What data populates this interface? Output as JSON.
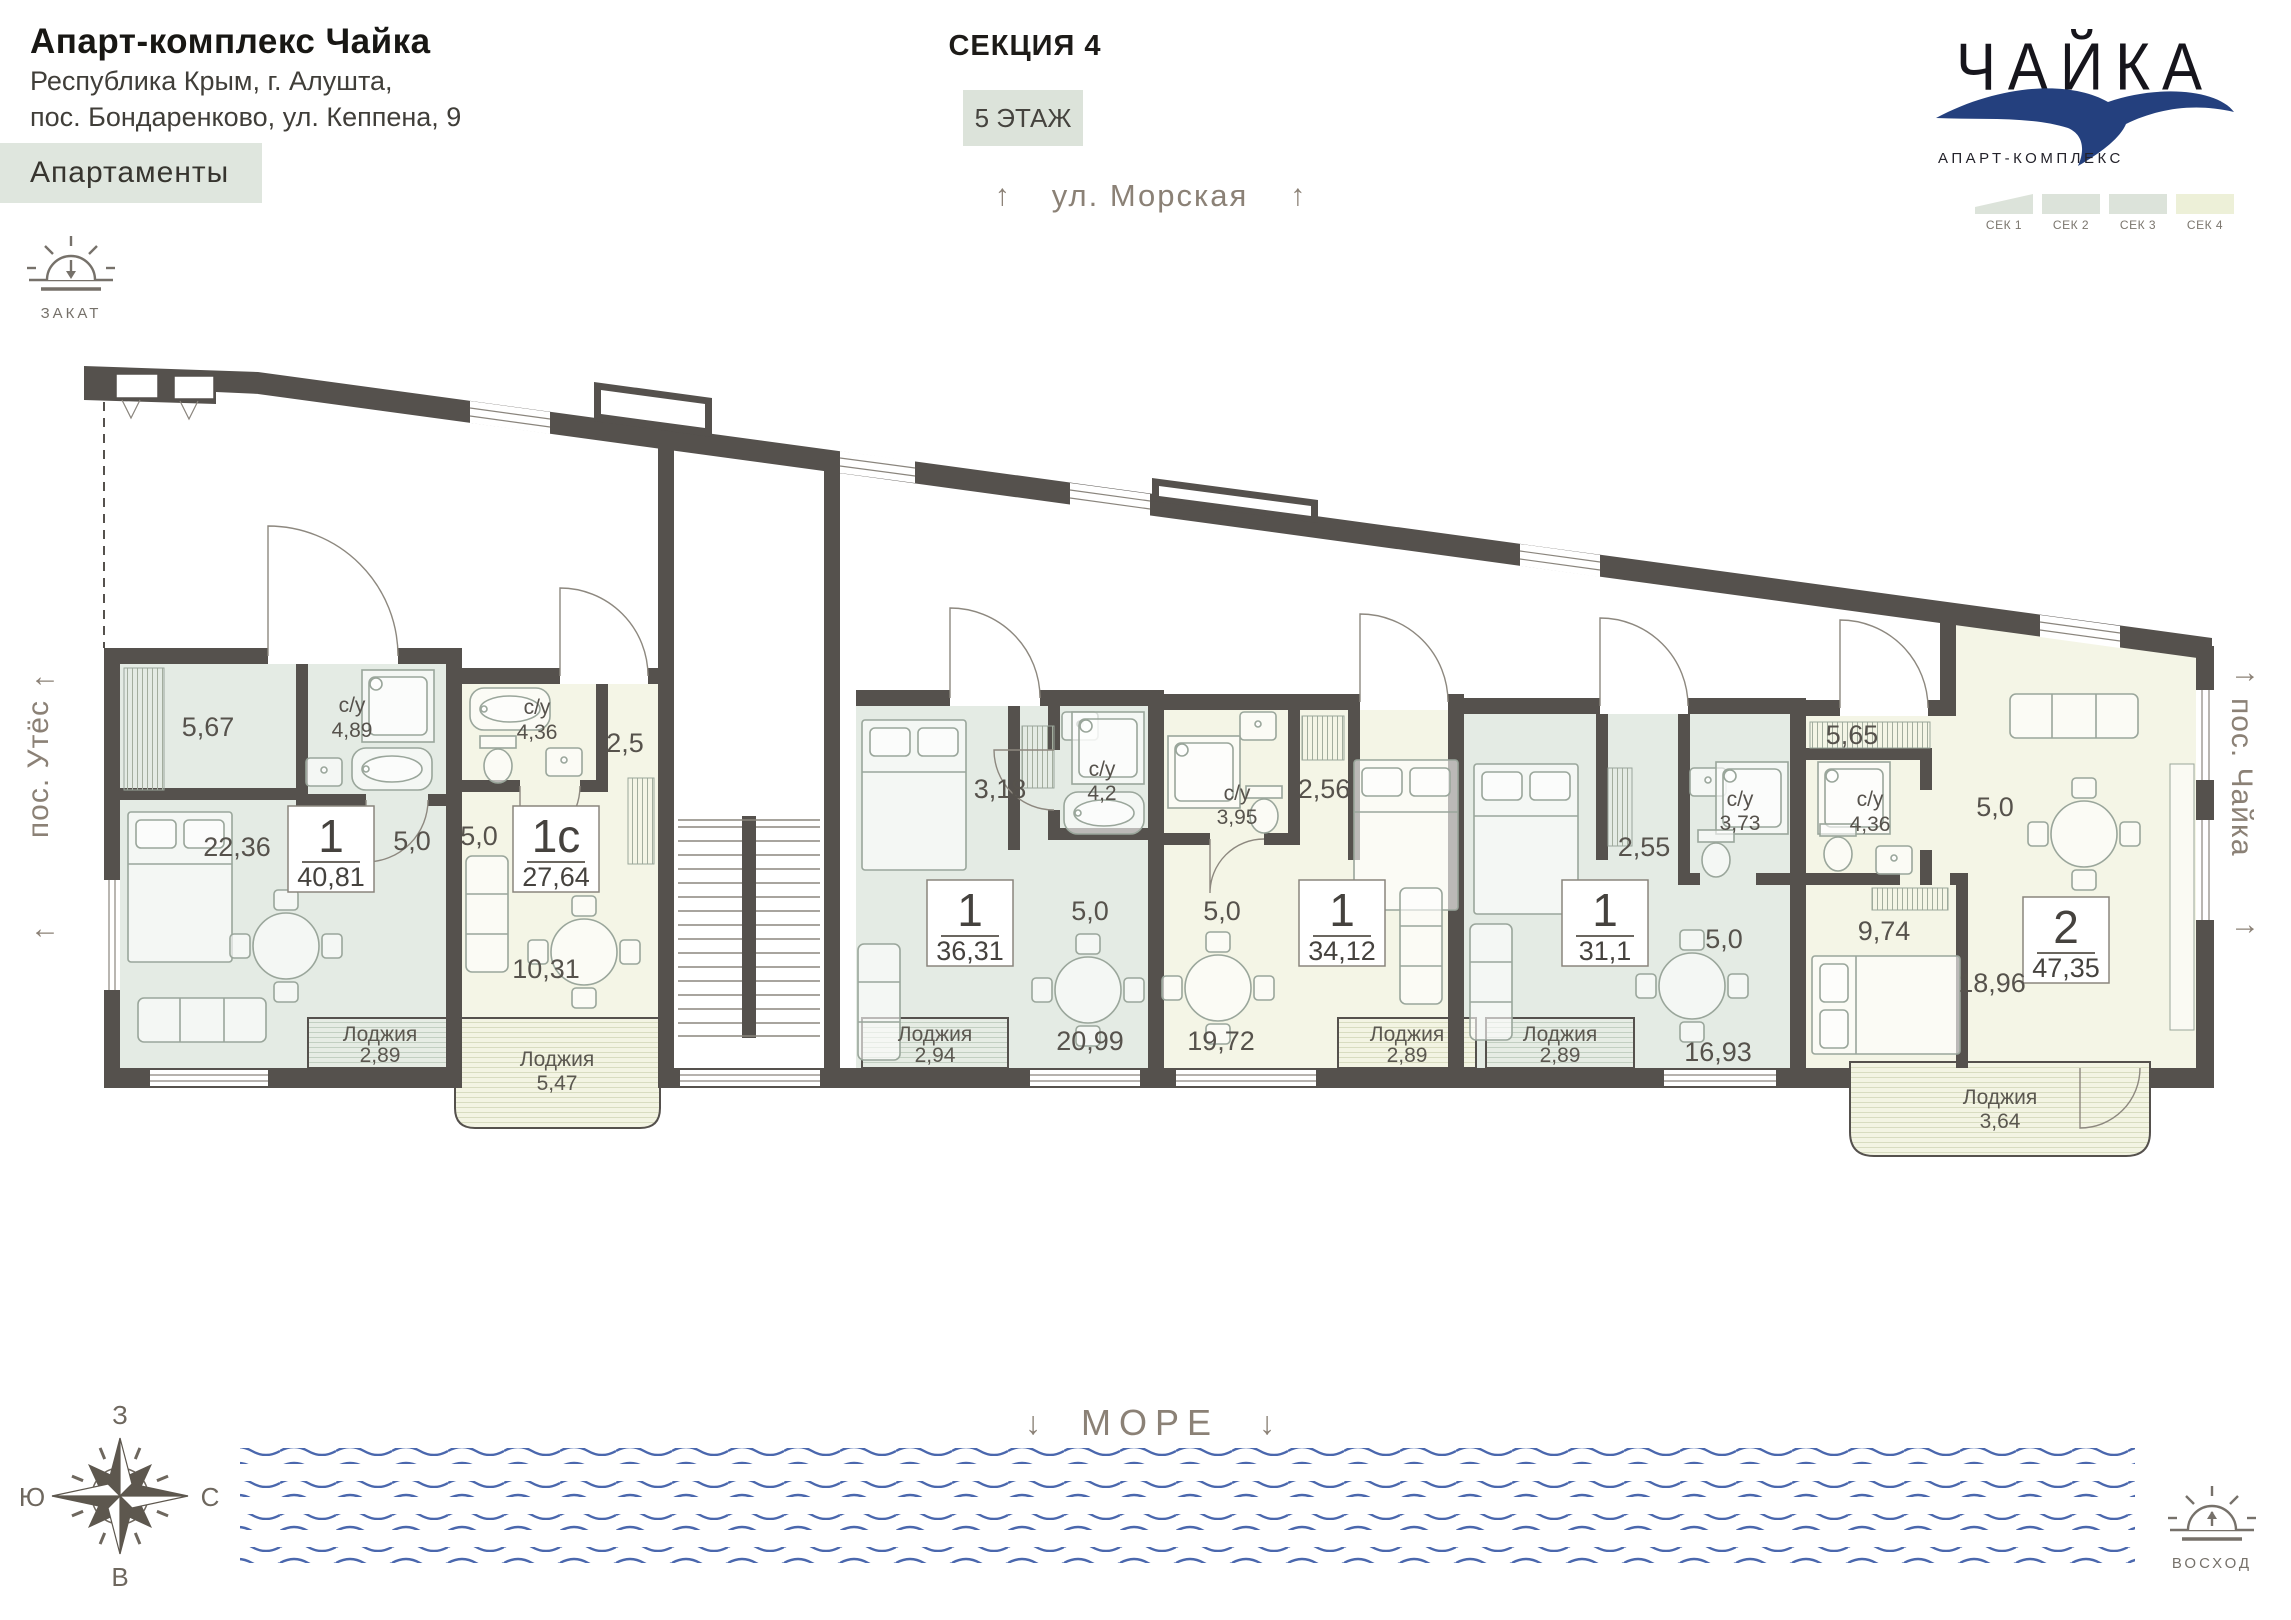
{
  "header": {
    "title": "Апарт-комплекс Чайка",
    "address1": "Республика Крым, г. Алушта,",
    "address2": "пос. Бондаренково, ул. Кеппена, 9",
    "apartments_label": "Апартаменты",
    "section": "СЕКЦИЯ 4",
    "floor_label": "5 ЭТАЖ"
  },
  "logo": {
    "name": "ЧАЙКА",
    "subtitle": "АПАРТ-КОМПЛЕКС",
    "seagull_color": "#24407e"
  },
  "sections": [
    {
      "label": "СЕК 1",
      "active": false
    },
    {
      "label": "СЕК 2",
      "active": false
    },
    {
      "label": "СЕК 3",
      "active": false
    },
    {
      "label": "СЕК 4",
      "active": true
    }
  ],
  "orientation": {
    "street": "ул. Морская",
    "settlement_left": "пос. Утёс",
    "settlement_right": "пос. Чайка",
    "sea": "МОРЕ",
    "sunset": "ЗАКАТ",
    "sunrise": "ВОСХОД",
    "compass": {
      "west": "З",
      "south": "Ю",
      "north": "С",
      "east": "В"
    }
  },
  "icons": {
    "up": "↑",
    "down": "↓",
    "left": "←",
    "right": "→"
  },
  "apartments": [
    {
      "number": "1",
      "area": "40,81",
      "hall": "5,67",
      "su": "с/у",
      "su_area": "4,89",
      "living": "22,36",
      "kitchen": "5,0",
      "loggia": "Лоджия",
      "loggia_area": "2,89"
    },
    {
      "number": "1с",
      "area": "27,64",
      "hall": "2,5",
      "su": "с/у",
      "su_area": "4,36",
      "living": "10,31",
      "kitchen": "5,0",
      "loggia": "Лоджия",
      "loggia_area": "5,47"
    },
    {
      "number": "1",
      "area": "36,31",
      "hall": "3,18",
      "su": "с/у",
      "su_area": "4,2",
      "living": "20,99",
      "kitchen": "5,0",
      "loggia": "Лоджия",
      "loggia_area": "2,94"
    },
    {
      "number": "1",
      "area": "34,12",
      "hall": "2,56",
      "su": "с/у",
      "su_area": "3,95",
      "living": "19,72",
      "kitchen": "5,0",
      "loggia": "Лоджия",
      "loggia_area": "2,89"
    },
    {
      "number": "1",
      "area": "31,1",
      "hall": "2,55",
      "su": "с/у",
      "su_area": "3,73",
      "living": "16,93",
      "kitchen": "5,0",
      "loggia": "Лоджия",
      "loggia_area": "2,89"
    },
    {
      "number": "2",
      "area": "47,35",
      "hall": "5,65",
      "su": "с/у",
      "su_area": "4,36",
      "living": "18,96",
      "kitchen": "5,0",
      "bedroom": "9,74",
      "loggia": "Лоджия",
      "loggia_area": "3,64"
    }
  ],
  "colors": {
    "wall": "#55514d",
    "fill_green": "#e4ebe4",
    "fill_cream": "#f4f5e6",
    "wave_blue": "#4a67ad"
  }
}
